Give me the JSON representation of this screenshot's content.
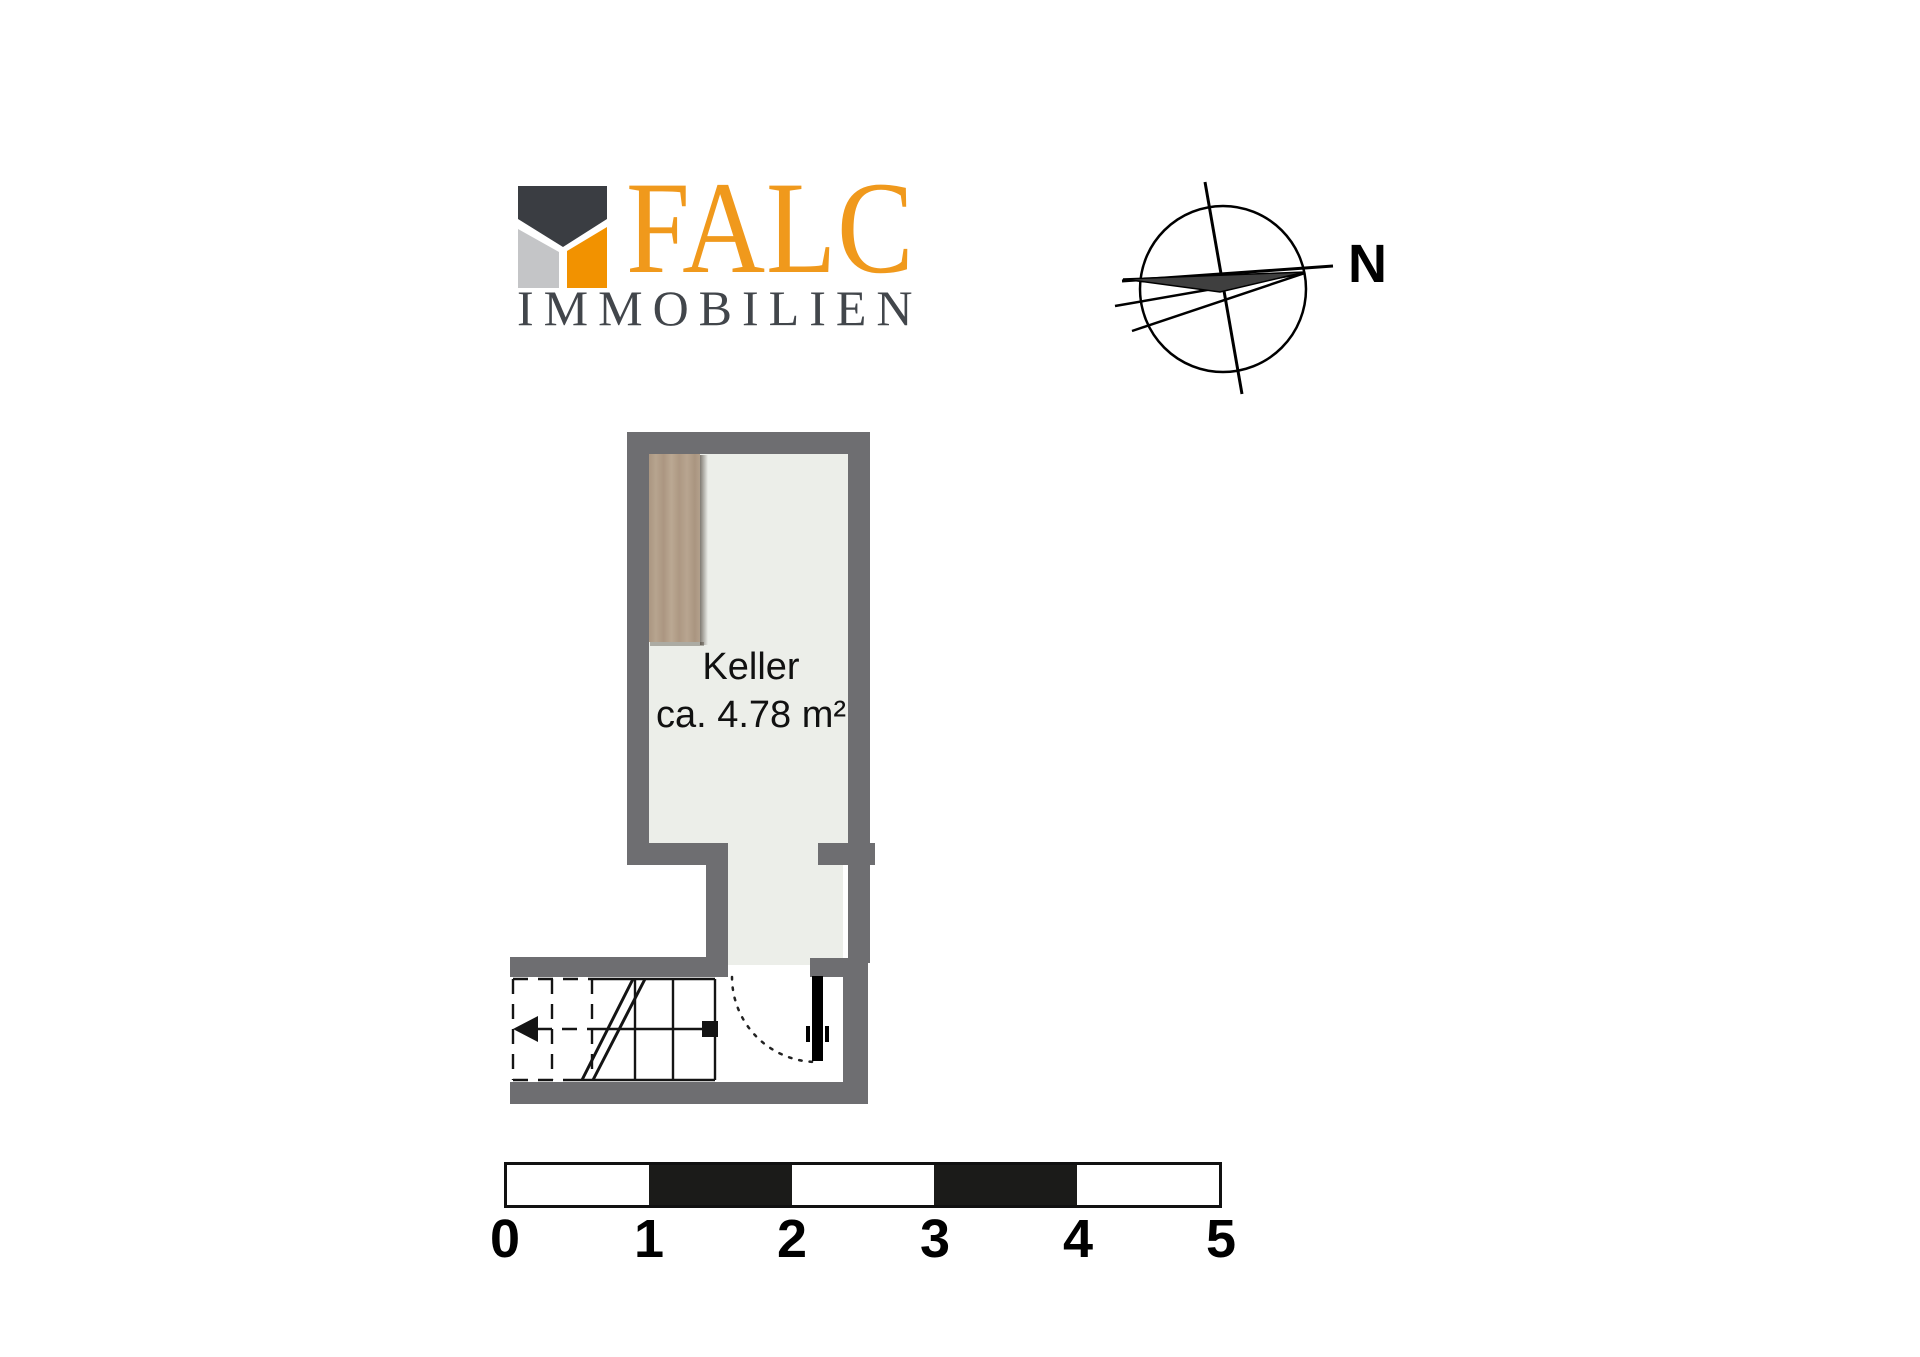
{
  "branding": {
    "name": "FALC",
    "subtitle": "IMMOBILIEN",
    "name_color": "#f0991c",
    "subtitle_color": "#42464b",
    "icon_colors": {
      "charcoal": "#3a3d42",
      "silver": "#c4c5c7",
      "orange": "#f29200"
    }
  },
  "compass": {
    "north_label": "N",
    "line_color": "#000000",
    "needle_fill": "#3f3f3f"
  },
  "floorplan": {
    "room": {
      "name": "Keller",
      "area": "ca. 4.78 m²"
    },
    "colors": {
      "wall": "#6e6e71",
      "floor": "#eceee9",
      "hall_floor": "#ffffff",
      "line": "#141414",
      "door": "#000000",
      "cabinet_wood": "#b3a08c",
      "text": "#111111"
    }
  },
  "scale_bar": {
    "labels": [
      "0",
      "1",
      "2",
      "3",
      "4",
      "5"
    ],
    "segment_colors": [
      "#ffffff",
      "#1b1b19",
      "#ffffff",
      "#1b1b19",
      "#ffffff"
    ]
  }
}
